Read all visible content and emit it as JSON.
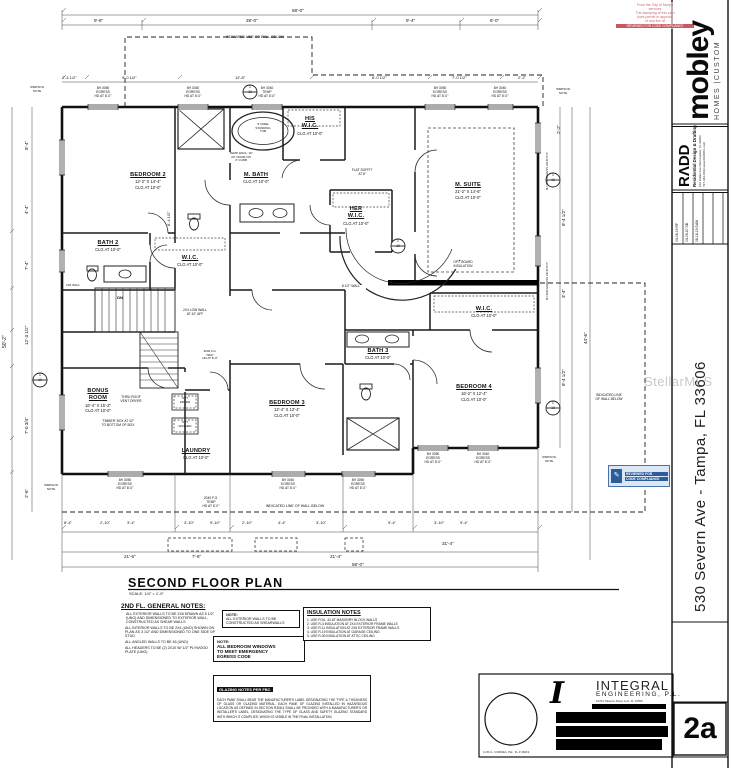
{
  "watermark": "StellarMLS",
  "stamp": {
    "lines": [
      "From the City of Tampa",
      "services",
      "The stamping of this plan",
      "does permit or approve",
      "of any line at"
    ],
    "banner": "REVIEWED FOR CODE COMPLIANCE"
  },
  "reviewed_stamp": {
    "line1": "REVIEWED FOR",
    "line2": "CODE COMPLIANCE"
  },
  "sidebar": {
    "logo_big": "mobley",
    "logo_sub": "HOMES |CUSTOM",
    "radd": {
      "logo": "RΛDD",
      "tagline": "Residential Design & Drafting",
      "addr1": "102 Indian Ave   Palm Harbor, FL 34683",
      "addr2": "727-442-0193   www.RADDFL.com"
    },
    "revisions": [
      {
        "entry": "04-08-19   RF"
      },
      {
        "entry": "04-09-20   SB"
      },
      {
        "entry": "08-18-19   DAM"
      }
    ],
    "address": "530 Severn Ave - Tampa, FL 33606",
    "sheet": "2a"
  },
  "engineer": {
    "logo": "I",
    "name": "INTEGRAL",
    "name2": "ENGINEERING, P.L.",
    "addr": "16764 Tobacco Road, Lutz, FL 33558",
    "pe": "LUIS G. CORREA, P.E., FL # 46019"
  },
  "plan": {
    "title": "SECOND FLOOR PLAN",
    "scale": "SCALE: 1/4\" = 1'-0\"",
    "rooms": {
      "b2": {
        "n": "BEDROOM 2",
        "s": "12'-2\" X 14'-4\"",
        "c": "CLG AT 10'-0\""
      },
      "bath2": {
        "n": "BATH 2",
        "s": "",
        "c": "CLG AT 10'-0\""
      },
      "mb": {
        "n": "M. BATH",
        "s": "",
        "c": "CLG AT 10'-0\""
      },
      "hw": {
        "n": "HIS\nW.I.C.",
        "s": "",
        "c": "CLG AT 10'-0\""
      },
      "herw": {
        "n": "HER\nW.I.C.",
        "s": "",
        "c": "CLG AT 10'-0\""
      },
      "ms": {
        "n": "M. SUITE",
        "s": "21'-2\" X 14'-6\"",
        "c": "CLG AT 10'-0\""
      },
      "wicc": {
        "n": "W.I.C.",
        "s": "",
        "c": "CLG AT 10'-0\""
      },
      "wic4": {
        "n": "W.I.C.",
        "s": "",
        "c": "CLG AT 10'-0\""
      },
      "bath3": {
        "n": "BATH 3",
        "s": "",
        "c": "CLG AT 10'-0\""
      },
      "b3": {
        "n": "BEDROOM 3",
        "s": "12'-4\" X 13'-4\"",
        "c": "CLG AT 10'-0\""
      },
      "b4": {
        "n": "BEDROOM 4",
        "s": "16'-2\" X 12'-4\"",
        "c": "CLG AT 10'-0\""
      },
      "bonus": {
        "n": "BONUS\nROOM",
        "s": "16'-4\" X 15'-2\"",
        "c": "CLG AT 10'-0\""
      },
      "laun": {
        "n": "LAUNDRY",
        "s": "",
        "c": "CLG AT 10'-0\""
      }
    },
    "labels": {
      "wall_below": "INDICATED LINE OF WALL BELOW",
      "wall_below2": "INDICATED LINE\nOF WALL BELOW",
      "low_wall": "2X4 LOW WALL\nAT 42\" AFF",
      "tub": "5' FREE\nSTANDING\nTUB",
      "encl": "TEMP. ENCL. W/\n24\" DOOR ON\n4\" CURB",
      "soffit": "FLAT SOFFIT\nAT 8'",
      "vent": "THRU ROOF\nVENT DRYER",
      "timber": "'TIMBER' BOX AT 42\"\nTO BOTTOM OF BOX",
      "optd": "OPT\nDRYER",
      "optw": "OPT\nWASHER",
      "wall85": "8 1/2\" WALL",
      "optboard": "OPT. BOARD\nINSULATION",
      "dn": "DN",
      "wall26": "2X6 WALL",
      "simpson": "SIMPSON\nNOTE",
      "win_eg": "8H 3050\nEGRESS\nHD AT 8'-0\"",
      "win_eg2": "8H 3040\nEGRESS\nHD AT 8'-0\"",
      "win_tmp": "8H 3040\nTEMP\nHD AT 8'-0\"",
      "win_fg": "2040 F.G.\nTEMP\nHD AT 8'-0\"",
      "win_right": "8H 3030 EGRESS HD AT 8'-0\"",
      "tray": "3040 F.G.\nTRAY\nHD AT 8'-0\""
    },
    "markers": {
      "top": "1",
      "bot": "10"
    },
    "dims": {
      "t0": "58'-0\"",
      "t1": [
        "9'-8\"",
        "28'-0\"",
        "9'-4\"",
        "8'-0\""
      ],
      "t2": [
        "2'-4 1/2\"",
        "9'-0 1/2\"",
        "12'-8\"",
        "8'-0 1/2\"",
        "7'-0 1/2\"",
        "2'-2\""
      ],
      "l0": "50'-2\"",
      "l": [
        "8'-4\"",
        "4'-4\"",
        "7'-4\"",
        "12'-3 1/2\"",
        "7'-0 3/4\"",
        "2'-6\""
      ],
      "r": [
        "2'-2\"",
        "8'-4 1/2\"",
        "3'-4\"",
        "8'-4 1/2\"",
        "44'-6\""
      ],
      "b1": [
        "8'-4\"",
        "2'-10\"",
        "3'-4\"",
        "3'-10\"",
        "9'-10\"",
        "2'-10\"",
        "4'-4\"",
        "3'-10\"",
        "9'-4\"",
        "3'-10\"",
        "9'-4\""
      ],
      "b2": [
        "21'-6\"",
        "7'-6\"",
        "21'-4\"",
        "31'-4\""
      ],
      "b0": "58'-0\"",
      "i1": "8'-4 1/2\""
    }
  },
  "notes": {
    "general": {
      "heading": "2ND FL. GENERAL NOTES:",
      "items": [
        "ALL EXTERIOR WALLS TO BE 2X6 DRAWN AS 5 1/2\" (UNO) AND DIMENSIONED TO EXTERIOR WALL, CONSTRUCTED AS SHEAR WALLS",
        "ALL INTERIOR WALLS TO BE 2X4 (UNO) SHOWN ON PLAN AS 3 1/2\" AND DIMENSIONED TO ONE SIDE OF STUD",
        "ALL ANGLED WALLS TO BE 45 (UNO)",
        "ALL HEADERS TO BE (2) 2X10 W/ 1/2\" PLYWOOD PLATE (UNO)"
      ]
    },
    "note1": {
      "heading": "NOTE:",
      "body": "ALL EXTERIOR WALLS TO BE\nCONSTRUCTED AS SHEARWALLS"
    },
    "note2": {
      "heading": "NOTE:",
      "body": "ALL BEDROOM WINDOWS\nTO MEET EMERGENCY\nEGRESS CODE"
    },
    "insulation": {
      "heading": "INSULATION NOTES",
      "items": [
        "1. USE FOIL .42 AT MASONRY BLOCK WALLS",
        "2. USE R-4 INSULATION AT 2X4 EXTERIOR FRAME WALLS",
        "3. USE R-11 INSULATION AT 2X6 EXTERIOR FRAME WALLS",
        "4. USE R-19 INSULATION AT GARAGE CEILING",
        "5. USE R-30 INSULATION AT ATTIC CEILING"
      ]
    },
    "glazing": {
      "heading": "GLAZING NOTES PER FBC",
      "body": "EACH PANE SHALL BEAR THE MANUFACTURER'S LABEL DESIGNATING THE TYPE & THICKNESS OF GLASS OR GLAZING MATERIAL. EACH PANE OF GLAZING INSTALLED IN HAZARDOUS LOCATION AS DEFINED IN SECTION R308.4 SHALL BE PROVIDED WITH A MANUFACTURER'S OR INSTALLER'S LABEL, DESIGNATING THE TYPE OF GLASS AND SAFETY GLAZING STANDARD WITH WHICH IT COMPLIES, WHICH IS VISIBLE IN THE FINAL INSTALLATION."
    }
  }
}
